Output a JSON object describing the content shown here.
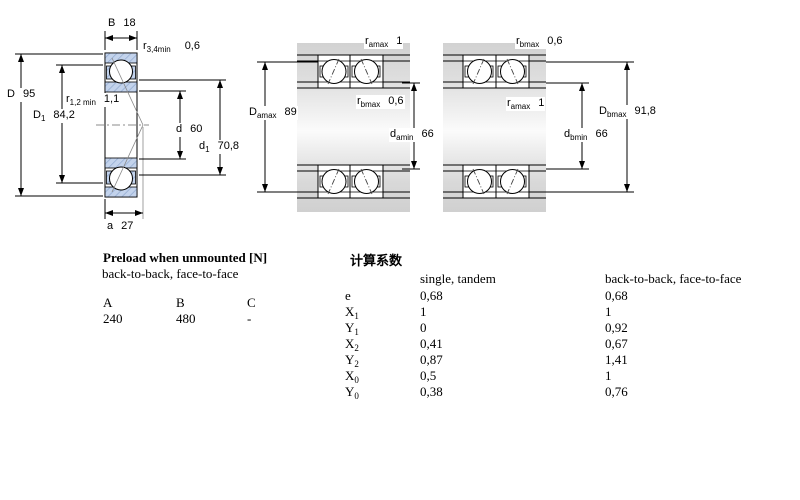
{
  "dims": {
    "b": {
      "sym": "B",
      "sub": "",
      "val": "18"
    },
    "r34": {
      "sym": "r",
      "sub": "3,4min",
      "val": "0,6"
    },
    "D": {
      "sym": "D",
      "sub": "",
      "val": "95"
    },
    "D1": {
      "sym": "D",
      "sub": "1",
      "val": "84,2"
    },
    "r12": {
      "sym": "r",
      "sub": "1,2 min",
      "val": "1,1"
    },
    "d": {
      "sym": "d",
      "sub": "",
      "val": "60"
    },
    "d1": {
      "sym": "d",
      "sub": "1",
      "val": "70,8"
    },
    "a": {
      "sym": "a",
      "sub": "",
      "val": "27"
    },
    "ra_bb": {
      "sym": "r",
      "sub": "amax",
      "val": "1"
    },
    "Da": {
      "sym": "D",
      "sub": "amax",
      "val": "89"
    },
    "rb_bb": {
      "sym": "r",
      "sub": "bmax",
      "val": "0,6"
    },
    "da": {
      "sym": "d",
      "sub": "amin",
      "val": "66"
    },
    "rb_ff": {
      "sym": "r",
      "sub": "bmax",
      "val": "0,6"
    },
    "ra_ff": {
      "sym": "r",
      "sub": "amax",
      "val": "1"
    },
    "Db": {
      "sym": "D",
      "sub": "bmax",
      "val": "91,8"
    },
    "db": {
      "sym": "d",
      "sub": "bmin",
      "val": "66"
    }
  },
  "preload": {
    "title": "Preload when unmounted [N]",
    "subtitle": "back-to-back, face-to-face",
    "columns": [
      "A",
      "B",
      "C"
    ],
    "values": [
      "240",
      "480",
      "-"
    ]
  },
  "factors": {
    "title": "计算系数",
    "col1": "single, tandem",
    "col2": "back-to-back, face-to-face",
    "rows": [
      {
        "sym": "e",
        "sub": "",
        "v1": "0,68",
        "v2": "0,68"
      },
      {
        "sym": "X",
        "sub": "1",
        "v1": "1",
        "v2": "1"
      },
      {
        "sym": "Y",
        "sub": "1",
        "v1": "0",
        "v2": "0,92"
      },
      {
        "sym": "X",
        "sub": "2",
        "v1": "0,41",
        "v2": "0,67"
      },
      {
        "sym": "Y",
        "sub": "2",
        "v1": "0,87",
        "v2": "1,41"
      },
      {
        "sym": "X",
        "sub": "0",
        "v1": "0,5",
        "v2": "1"
      },
      {
        "sym": "Y",
        "sub": "0",
        "v1": "0,38",
        "v2": "0,76"
      }
    ]
  },
  "colors": {
    "ring_fill": "#c3d3ec",
    "ring_hatch": "#8fa8d0",
    "line": "#000000",
    "shaft_gray": "#d6d6d6"
  }
}
